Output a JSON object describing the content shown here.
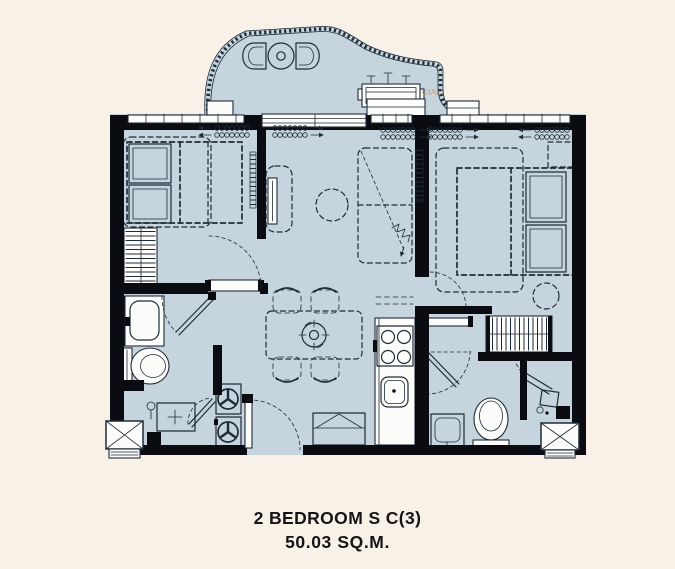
{
  "title": {
    "line1": "2 BEDROOM S C(3)",
    "line2": "50.03 SQ.M."
  },
  "watermark": "CIAL'",
  "colors": {
    "background": "#f8f1e8",
    "floor": "#c5d4dd",
    "wall": "#0b0c11",
    "ink": "#202b38",
    "paper": "#fcfcfa",
    "accent": "#c49a5f",
    "title": "#151515"
  },
  "plan": {
    "unit_type": "2 BEDROOM S C(3)",
    "area": "50.03 SQ.M.",
    "symbols": [
      "balcony-railing",
      "lounge-chair",
      "round-table",
      "ac-condenser-unit",
      "single-bed",
      "double-bed",
      "pillow",
      "wardrobe-hangers",
      "sliding-door",
      "tv",
      "tv-console",
      "sofa",
      "coffee-table",
      "curtain-coil",
      "dining-table",
      "dining-chair",
      "ceiling-fan",
      "kitchen-counter",
      "stove-4-burner",
      "kitchen-sink",
      "refrigerator",
      "washer",
      "dryer",
      "laundry-basin",
      "toilet",
      "vanity-sink",
      "shower-head",
      "door-swing-arc",
      "service-shaft",
      "vent-grille"
    ]
  }
}
